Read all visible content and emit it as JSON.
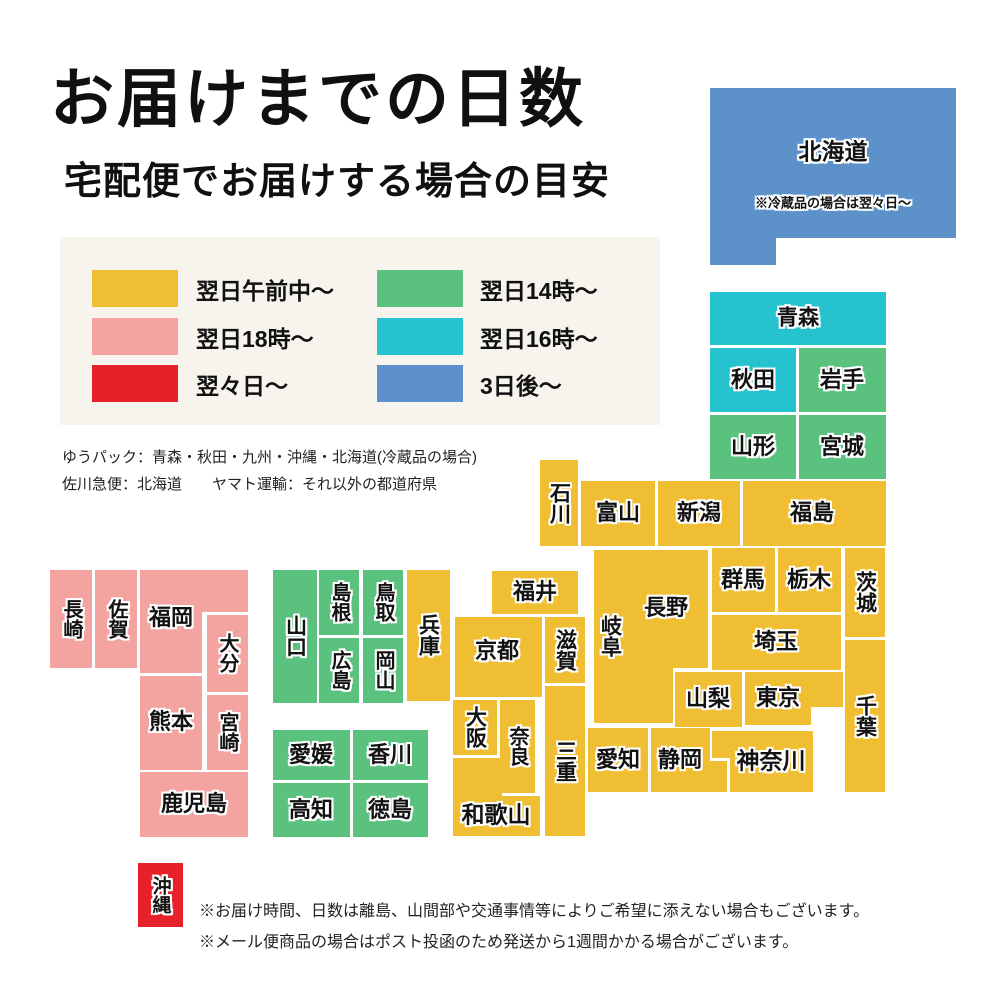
{
  "title": "お届けまでの日数",
  "subtitle": "宅配便でお届けする場合の目安",
  "colors": {
    "next_morning": "#F0BE33",
    "next_18": "#F3A3A0",
    "in_2_days": "#E7212A",
    "next_14": "#5BC17E",
    "next_16": "#26C2CF",
    "in_3_days": "#5C92C9",
    "legend_bg": "#F7F4ED",
    "label_text": "#121212"
  },
  "legend": {
    "items": [
      {
        "label": "翌日午前中〜",
        "color": "next_morning"
      },
      {
        "label": "翌日18時〜",
        "color": "next_18"
      },
      {
        "label": "翌々日〜",
        "color": "in_2_days"
      },
      {
        "label": "翌日14時〜",
        "color": "next_14"
      },
      {
        "label": "翌日16時〜",
        "color": "next_16"
      },
      {
        "label": "3日後〜",
        "color": "in_3_days"
      }
    ]
  },
  "carrier_notes": [
    "ゆうパック：青森・秋田・九州・沖縄・北海道(冷蔵品の場合)",
    "佐川急便：北海道　　ヤマト運輸：それ以外の都道府県"
  ],
  "map": {
    "blocks": [
      {
        "id": "hokkaido",
        "name": "北海道",
        "color": "in_3_days",
        "orient": "h",
        "fz": 23,
        "rects": [
          [
            710,
            88,
            246,
            150
          ],
          [
            710,
            238,
            66,
            27
          ]
        ],
        "label": [
          833,
          152
        ],
        "sub": {
          "text": "※冷蔵品の場合は翌々日〜",
          "pos": [
            833,
            203
          ],
          "fz": 13
        }
      },
      {
        "id": "aomori",
        "name": "青森",
        "color": "next_16",
        "orient": "h",
        "fz": 21,
        "rects": [
          [
            710,
            292,
            176,
            53
          ]
        ],
        "label": [
          798,
          318
        ]
      },
      {
        "id": "akita",
        "name": "秋田",
        "color": "next_16",
        "orient": "h",
        "fz": 22,
        "rects": [
          [
            710,
            348,
            86,
            64
          ]
        ],
        "label": [
          753,
          380
        ]
      },
      {
        "id": "iwate",
        "name": "岩手",
        "color": "next_14",
        "orient": "h",
        "fz": 22,
        "rects": [
          [
            799,
            348,
            87,
            64
          ]
        ],
        "label": [
          842,
          380
        ]
      },
      {
        "id": "yamagata",
        "name": "山形",
        "color": "next_14",
        "orient": "h",
        "fz": 22,
        "rects": [
          [
            710,
            415,
            86,
            64
          ]
        ],
        "label": [
          753,
          447
        ]
      },
      {
        "id": "miyagi",
        "name": "宮城",
        "color": "next_14",
        "orient": "h",
        "fz": 22,
        "rects": [
          [
            799,
            415,
            87,
            64
          ]
        ],
        "label": [
          842,
          447
        ]
      },
      {
        "id": "ishikawa",
        "name": "石川",
        "color": "next_morning",
        "orient": "v",
        "fz": 21,
        "rects": [
          [
            540,
            460,
            38,
            86
          ]
        ],
        "label": [
          559,
          503
        ]
      },
      {
        "id": "toyama",
        "name": "富山",
        "color": "next_morning",
        "orient": "h",
        "fz": 22,
        "rects": [
          [
            581,
            481,
            74,
            65
          ]
        ],
        "label": [
          618,
          513
        ]
      },
      {
        "id": "niigata",
        "name": "新潟",
        "color": "next_morning",
        "orient": "h",
        "fz": 22,
        "rects": [
          [
            658,
            481,
            82,
            65
          ]
        ],
        "label": [
          699,
          513
        ]
      },
      {
        "id": "fukushima",
        "name": "福島",
        "color": "next_morning",
        "orient": "h",
        "fz": 22,
        "rects": [
          [
            743,
            481,
            143,
            65
          ]
        ],
        "label": [
          812,
          513
        ]
      },
      {
        "id": "fukui",
        "name": "福井",
        "color": "next_morning",
        "orient": "h",
        "fz": 22,
        "rects": [
          [
            492,
            571,
            86,
            43
          ]
        ],
        "label": [
          535,
          592
        ]
      },
      {
        "id": "kyoto",
        "name": "京都",
        "color": "next_morning",
        "orient": "h",
        "fz": 22,
        "rects": [
          [
            455,
            617,
            87,
            80
          ]
        ],
        "label": [
          497,
          651
        ]
      },
      {
        "id": "shiga",
        "name": "滋賀",
        "color": "next_morning",
        "orient": "v",
        "fz": 21,
        "rects": [
          [
            545,
            617,
            40,
            66
          ]
        ],
        "label": [
          565,
          650
        ]
      },
      {
        "id": "gifu",
        "name": "岐阜",
        "color": "next_morning",
        "orient": "v",
        "fz": 21,
        "rects": [
          [
            594,
            550,
            32,
            173
          ]
        ],
        "label": [
          610,
          636
        ]
      },
      {
        "id": "nagano",
        "name": "長野",
        "color": "next_morning",
        "orient": "h",
        "fz": 22,
        "rects": [
          [
            625,
            550,
            83,
            118
          ],
          [
            625,
            668,
            48,
            55
          ]
        ],
        "label": [
          666,
          608
        ]
      },
      {
        "id": "gunma",
        "name": "群馬",
        "color": "next_morning",
        "orient": "h",
        "fz": 22,
        "rects": [
          [
            712,
            548,
            63,
            64
          ]
        ],
        "label": [
          743,
          580
        ]
      },
      {
        "id": "tochigi",
        "name": "栃木",
        "color": "next_morning",
        "orient": "h",
        "fz": 22,
        "rects": [
          [
            778,
            548,
            63,
            64
          ]
        ],
        "label": [
          809,
          580
        ]
      },
      {
        "id": "ibaraki",
        "name": "茨城",
        "color": "next_morning",
        "orient": "v",
        "fz": 21,
        "rects": [
          [
            845,
            548,
            40,
            89
          ]
        ],
        "label": [
          865,
          592
        ]
      },
      {
        "id": "saitama",
        "name": "埼玉",
        "color": "next_morning",
        "orient": "h",
        "fz": 22,
        "rects": [
          [
            712,
            615,
            129,
            55
          ]
        ],
        "label": [
          776,
          642
        ]
      },
      {
        "id": "yamanashi",
        "name": "山梨",
        "color": "next_morning",
        "orient": "h",
        "fz": 22,
        "rects": [
          [
            675,
            672,
            67,
            55
          ]
        ],
        "label": [
          708,
          699
        ]
      },
      {
        "id": "tokyo",
        "name": "東京",
        "color": "next_morning",
        "orient": "h",
        "fz": 22,
        "rects": [
          [
            745,
            672,
            66,
            53
          ],
          [
            811,
            672,
            32,
            35
          ]
        ],
        "label": [
          778,
          698
        ]
      },
      {
        "id": "chiba",
        "name": "千葉",
        "color": "next_morning",
        "orient": "v",
        "fz": 21,
        "rects": [
          [
            845,
            640,
            40,
            152
          ]
        ],
        "label": [
          865,
          716
        ]
      },
      {
        "id": "kanagawa",
        "name": "神奈川",
        "color": "next_morning",
        "orient": "h",
        "fz": 23,
        "rects": [
          [
            712,
            731,
            101,
            27
          ],
          [
            730,
            758,
            83,
            34
          ]
        ],
        "label": [
          771,
          761
        ]
      },
      {
        "id": "shizuoka",
        "name": "静岡",
        "color": "next_morning",
        "orient": "h",
        "fz": 22,
        "rects": [
          [
            651,
            728,
            59,
            64
          ],
          [
            710,
            761,
            17,
            31
          ]
        ],
        "label": [
          680,
          760
        ]
      },
      {
        "id": "aichi",
        "name": "愛知",
        "color": "next_morning",
        "orient": "h",
        "fz": 22,
        "rects": [
          [
            588,
            728,
            60,
            64
          ]
        ],
        "label": [
          618,
          760
        ]
      },
      {
        "id": "mie",
        "name": "三重",
        "color": "next_morning",
        "orient": "v",
        "fz": 21,
        "rects": [
          [
            545,
            686,
            40,
            150
          ]
        ],
        "label": [
          565,
          761
        ]
      },
      {
        "id": "osaka",
        "name": "大阪",
        "color": "next_morning",
        "orient": "v",
        "fz": 21,
        "rects": [
          [
            453,
            700,
            44,
            55
          ]
        ],
        "label": [
          475,
          727
        ]
      },
      {
        "id": "nara",
        "name": "奈良",
        "color": "next_morning",
        "orient": "v",
        "fz": 20,
        "rects": [
          [
            500,
            700,
            35,
            93
          ]
        ],
        "label": [
          517,
          746
        ]
      },
      {
        "id": "wakayama",
        "name": "和歌山",
        "color": "next_morning",
        "orient": "h",
        "fz": 23,
        "rects": [
          [
            453,
            758,
            49,
            78
          ],
          [
            453,
            796,
            87,
            40
          ]
        ],
        "label": [
          496,
          815
        ]
      },
      {
        "id": "hyogo",
        "name": "兵庫",
        "color": "next_morning",
        "orient": "v",
        "fz": 21,
        "rects": [
          [
            407,
            570,
            43,
            131
          ]
        ],
        "label": [
          428,
          635
        ]
      },
      {
        "id": "yamaguchi",
        "name": "山口",
        "color": "next_14",
        "orient": "v",
        "fz": 21,
        "rects": [
          [
            273,
            570,
            44,
            133
          ]
        ],
        "label": [
          295,
          636
        ]
      },
      {
        "id": "shimane",
        "name": "島根",
        "color": "next_14",
        "orient": "v",
        "fz": 20,
        "rects": [
          [
            319,
            570,
            40,
            65
          ]
        ],
        "label": [
          339,
          602
        ]
      },
      {
        "id": "hiroshima",
        "name": "広島",
        "color": "next_14",
        "orient": "v",
        "fz": 20,
        "rects": [
          [
            319,
            638,
            40,
            65
          ]
        ],
        "label": [
          339,
          670
        ]
      },
      {
        "id": "tottori",
        "name": "鳥取",
        "color": "next_14",
        "orient": "v",
        "fz": 20,
        "rects": [
          [
            363,
            570,
            40,
            65
          ]
        ],
        "label": [
          383,
          602
        ]
      },
      {
        "id": "okayama",
        "name": "岡山",
        "color": "next_14",
        "orient": "v",
        "fz": 20,
        "rects": [
          [
            363,
            638,
            40,
            65
          ]
        ],
        "label": [
          383,
          670
        ]
      },
      {
        "id": "ehime",
        "name": "愛媛",
        "color": "next_14",
        "orient": "h",
        "fz": 22,
        "rects": [
          [
            273,
            730,
            77,
            50
          ]
        ],
        "label": [
          311,
          755
        ]
      },
      {
        "id": "kagawa",
        "name": "香川",
        "color": "next_14",
        "orient": "h",
        "fz": 22,
        "rects": [
          [
            353,
            730,
            75,
            50
          ]
        ],
        "label": [
          390,
          755
        ]
      },
      {
        "id": "kochi",
        "name": "高知",
        "color": "next_14",
        "orient": "h",
        "fz": 22,
        "rects": [
          [
            273,
            783,
            77,
            54
          ]
        ],
        "label": [
          311,
          810
        ]
      },
      {
        "id": "tokushima",
        "name": "徳島",
        "color": "next_14",
        "orient": "h",
        "fz": 22,
        "rects": [
          [
            353,
            783,
            75,
            54
          ]
        ],
        "label": [
          390,
          810
        ]
      },
      {
        "id": "nagasaki",
        "name": "長崎",
        "color": "next_18",
        "orient": "v",
        "fz": 20,
        "rects": [
          [
            50,
            570,
            42,
            98
          ]
        ],
        "label": [
          71,
          619
        ]
      },
      {
        "id": "saga",
        "name": "佐賀",
        "color": "next_18",
        "orient": "v",
        "fz": 20,
        "rects": [
          [
            95,
            570,
            42,
            98
          ]
        ],
        "label": [
          116,
          619
        ]
      },
      {
        "id": "fukuoka",
        "name": "福岡",
        "color": "next_18",
        "orient": "h",
        "fz": 22,
        "rects": [
          [
            140,
            570,
            108,
            42
          ],
          [
            140,
            612,
            62,
            61
          ]
        ],
        "label": [
          171,
          618
        ]
      },
      {
        "id": "oita",
        "name": "大分",
        "color": "next_18",
        "orient": "v",
        "fz": 20,
        "rects": [
          [
            207,
            615,
            41,
            77
          ]
        ],
        "label": [
          227,
          653
        ]
      },
      {
        "id": "kumamoto",
        "name": "熊本",
        "color": "next_18",
        "orient": "h",
        "fz": 22,
        "rects": [
          [
            140,
            676,
            62,
            94
          ]
        ],
        "label": [
          171,
          722
        ]
      },
      {
        "id": "miyazaki",
        "name": "宮崎",
        "color": "next_18",
        "orient": "v",
        "fz": 20,
        "rects": [
          [
            207,
            695,
            41,
            75
          ]
        ],
        "label": [
          227,
          732
        ]
      },
      {
        "id": "kagoshima",
        "name": "鹿児島",
        "color": "next_18",
        "orient": "h",
        "fz": 22,
        "rects": [
          [
            140,
            772,
            108,
            65
          ]
        ],
        "label": [
          194,
          804
        ]
      },
      {
        "id": "okinawa",
        "name": "沖縄",
        "color": "in_2_days",
        "orient": "v",
        "fz": 19,
        "rects": [
          [
            138,
            863,
            45,
            64
          ]
        ],
        "label": [
          160,
          895
        ]
      }
    ]
  },
  "footer_notes": [
    "※お届け時間、日数は離島、山間部や交通事情等によりご希望に添えない場合もございます。",
    "※メール便商品の場合はポスト投函のため発送から1週間かかる場合がございます。"
  ]
}
